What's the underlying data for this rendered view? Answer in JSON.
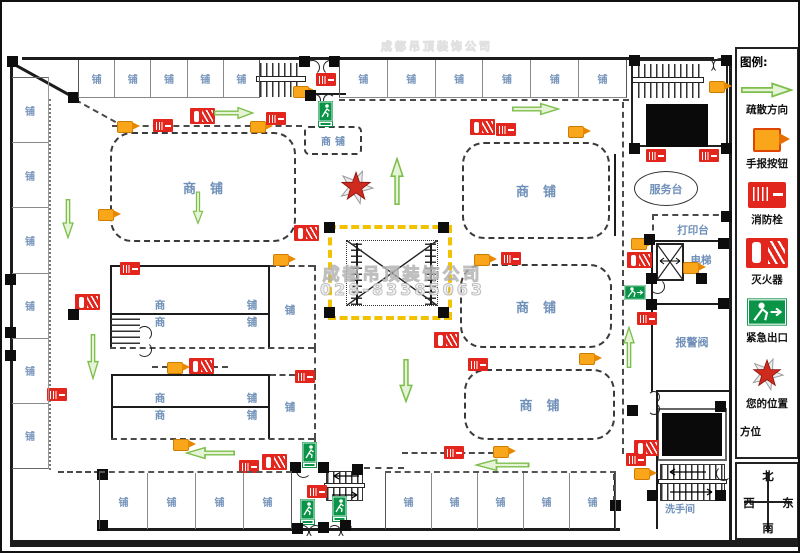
{
  "legend": {
    "title": "图例:",
    "items": [
      {
        "icon": "evacuation-arrow",
        "label": "疏散方向"
      },
      {
        "icon": "alarm-button",
        "label": "手报按钮"
      },
      {
        "icon": "fire-hydrant",
        "label": "消防栓"
      },
      {
        "icon": "fire-extinguisher",
        "label": "灭火器"
      },
      {
        "icon": "emergency-exit",
        "label": "紧急出口"
      },
      {
        "icon": "your-location-star",
        "label": "您的位置"
      },
      {
        "icon": "none",
        "label": "方位"
      }
    ]
  },
  "compass": {
    "north": "北",
    "west": "西",
    "east": "东",
    "south": "南"
  },
  "labels": {
    "shop": "铺",
    "shop_unit": "商铺",
    "shop_char1": "商",
    "shop_char2": "铺",
    "service_desk": "服务台",
    "print_desk": "打印台",
    "elevator": "电梯",
    "alarm_valve": "报警阀",
    "restroom": "洗手间"
  },
  "watermark": {
    "line1": "成都吊顶装饰公司",
    "line2": "028-83385063"
  },
  "colors": {
    "alarm_orange": "#FAA61A",
    "fire_red": "#E3261D",
    "exit_green": "#0A9447",
    "route_yellow": "#F2C200",
    "arrow_green": "#7CBF4B",
    "label_blue": "#6F90B8"
  },
  "plan": {
    "shop_rows": [
      {
        "x": 76,
        "y": 58,
        "w": 182,
        "h": 38,
        "n": 5,
        "dir": "h",
        "cls": "top"
      },
      {
        "x": 337,
        "y": 58,
        "w": 288,
        "h": 38,
        "n": 6,
        "dir": "h",
        "cls": "top"
      },
      {
        "x": 10,
        "y": 75,
        "w": 37,
        "h": 392,
        "n": 6,
        "dir": "v",
        "cls": "leftcol"
      },
      {
        "x": 97,
        "y": 469,
        "w": 193,
        "h": 58,
        "n": 4,
        "dir": "h",
        "cls": "bot"
      },
      {
        "x": 383,
        "y": 469,
        "w": 231,
        "h": 58,
        "n": 5,
        "dir": "h",
        "cls": "bot"
      }
    ],
    "markers": [
      {
        "t": "alarm",
        "x": 115,
        "y": 119
      },
      {
        "t": "alarm",
        "x": 248,
        "y": 119
      },
      {
        "t": "alarm",
        "x": 291,
        "y": 84
      },
      {
        "t": "alarm",
        "x": 566,
        "y": 124
      },
      {
        "t": "alarm",
        "x": 707,
        "y": 79
      },
      {
        "t": "alarm",
        "x": 96,
        "y": 207
      },
      {
        "t": "alarm",
        "x": 271,
        "y": 252
      },
      {
        "t": "alarm",
        "x": 165,
        "y": 360
      },
      {
        "t": "alarm",
        "x": 171,
        "y": 437
      },
      {
        "t": "alarm",
        "x": 472,
        "y": 252
      },
      {
        "t": "alarm",
        "x": 577,
        "y": 351
      },
      {
        "t": "alarm",
        "x": 491,
        "y": 444
      },
      {
        "t": "alarm",
        "x": 629,
        "y": 236
      },
      {
        "t": "alarm",
        "x": 681,
        "y": 260
      },
      {
        "t": "alarm",
        "x": 632,
        "y": 466
      },
      {
        "t": "hyd",
        "x": 151,
        "y": 117
      },
      {
        "t": "hyd",
        "x": 264,
        "y": 110
      },
      {
        "t": "hyd",
        "x": 494,
        "y": 121
      },
      {
        "t": "hyd",
        "x": 644,
        "y": 147
      },
      {
        "t": "hyd",
        "x": 697,
        "y": 147
      },
      {
        "t": "hyd",
        "x": 118,
        "y": 260
      },
      {
        "t": "hyd",
        "x": 293,
        "y": 368
      },
      {
        "t": "hyd",
        "x": 45,
        "y": 386
      },
      {
        "t": "hyd",
        "x": 442,
        "y": 444
      },
      {
        "t": "hyd",
        "x": 237,
        "y": 458
      },
      {
        "t": "hyd",
        "x": 305,
        "y": 483
      },
      {
        "t": "hyd",
        "x": 624,
        "y": 451
      },
      {
        "t": "hyd",
        "x": 635,
        "y": 310
      },
      {
        "t": "hyd",
        "x": 466,
        "y": 356
      },
      {
        "t": "hyd",
        "x": 499,
        "y": 250
      },
      {
        "t": "hyd",
        "x": 314,
        "y": 71
      },
      {
        "t": "ext",
        "x": 188,
        "y": 106
      },
      {
        "t": "ext",
        "x": 468,
        "y": 117
      },
      {
        "t": "ext",
        "x": 292,
        "y": 223
      },
      {
        "t": "ext",
        "x": 73,
        "y": 292
      },
      {
        "t": "ext",
        "x": 187,
        "y": 356
      },
      {
        "t": "ext",
        "x": 432,
        "y": 330
      },
      {
        "t": "ext",
        "x": 625,
        "y": 250
      },
      {
        "t": "ext",
        "x": 632,
        "y": 438
      },
      {
        "t": "ext",
        "x": 260,
        "y": 452
      },
      {
        "t": "exitv",
        "x": 316,
        "y": 99
      },
      {
        "t": "exitv",
        "x": 300,
        "y": 440
      },
      {
        "t": "exitv",
        "x": 298,
        "y": 497
      },
      {
        "t": "exitv",
        "x": 330,
        "y": 494
      },
      {
        "t": "exith",
        "x": 622,
        "y": 283
      },
      {
        "t": "arrow",
        "x": 212,
        "y": 104,
        "w": 40,
        "h": 13,
        "r": 0
      },
      {
        "t": "arrow",
        "x": 510,
        "y": 100,
        "w": 48,
        "h": 13,
        "r": 0
      },
      {
        "t": "arrow",
        "x": 388,
        "y": 155,
        "w": 14,
        "h": 48,
        "r": 270
      },
      {
        "t": "arrow",
        "x": 397,
        "y": 357,
        "w": 14,
        "h": 44,
        "r": 90
      },
      {
        "t": "arrow",
        "x": 621,
        "y": 324,
        "w": 12,
        "h": 42,
        "r": 270
      },
      {
        "t": "arrow",
        "x": 60,
        "y": 197,
        "w": 12,
        "h": 40,
        "r": 90
      },
      {
        "t": "arrow",
        "x": 85,
        "y": 332,
        "w": 12,
        "h": 46,
        "r": 90
      },
      {
        "t": "arrow",
        "x": 190,
        "y": 189,
        "w": 11,
        "h": 33,
        "r": 90
      },
      {
        "t": "arrow",
        "x": 183,
        "y": 444,
        "w": 50,
        "h": 13,
        "r": 180
      },
      {
        "t": "arrow",
        "x": 472,
        "y": 456,
        "w": 55,
        "h": 13,
        "r": 180
      },
      {
        "t": "star",
        "x": 335,
        "y": 166
      }
    ],
    "columns": [
      [
        5,
        54
      ],
      [
        66,
        90
      ],
      [
        297,
        54
      ],
      [
        327,
        54
      ],
      [
        303,
        88
      ],
      [
        627,
        53
      ],
      [
        719,
        53
      ],
      [
        627,
        141
      ],
      [
        719,
        141
      ],
      [
        322,
        220
      ],
      [
        436,
        220
      ],
      [
        322,
        305
      ],
      [
        436,
        305
      ],
      [
        3,
        272
      ],
      [
        3,
        325
      ],
      [
        3,
        348
      ],
      [
        66,
        307
      ],
      [
        95,
        467
      ],
      [
        95,
        518
      ],
      [
        288,
        460
      ],
      [
        316,
        460
      ],
      [
        350,
        462
      ],
      [
        290,
        521
      ],
      [
        316,
        520
      ],
      [
        338,
        518
      ],
      [
        608,
        498
      ],
      [
        645,
        488
      ],
      [
        713,
        488
      ],
      [
        713,
        399
      ],
      [
        642,
        232
      ],
      [
        719,
        209
      ],
      [
        716,
        236
      ],
      [
        644,
        271
      ],
      [
        694,
        271
      ],
      [
        644,
        297
      ],
      [
        716,
        296
      ],
      [
        625,
        403
      ]
    ]
  }
}
